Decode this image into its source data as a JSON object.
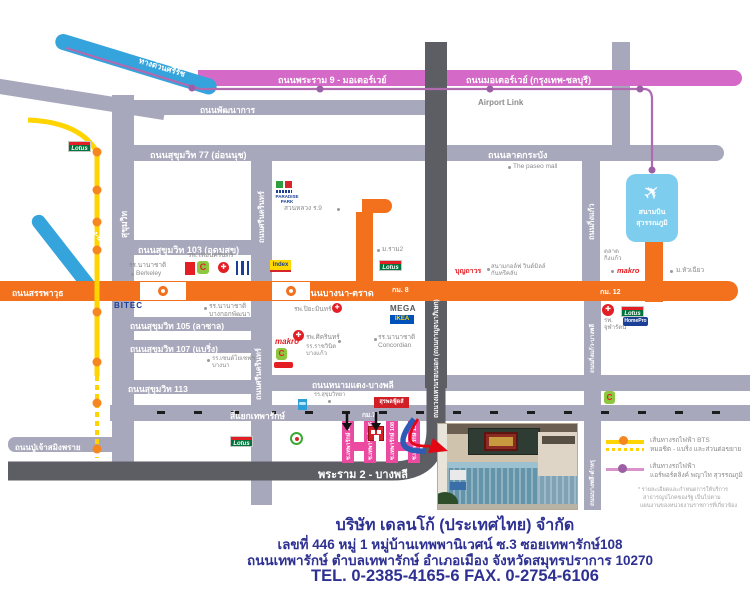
{
  "map": {
    "roads": {
      "expressway_srirat": "ทางด่วนศรีรัช",
      "rama9_motorway": "ถนนพระราม 9 - มอเตอร์เวย์",
      "motorway_bkk_chonburi": "ถนนมอเตอร์เวย์ (กรุงเทพ-ชลบุรี)",
      "airport_link": "Airport Link",
      "phetchaburi_tat_mai": "ถนนเพชรบุรีตัดใหม่",
      "phatthanakan": "ถนนพัฒนาการ",
      "sukhumvit77": "ถนนสุขุมวิท 77 (อ่อนนุช)",
      "lat_krabang": "ถนนลาดกระบัง",
      "sukhumvit": "สุขุมวิท",
      "sukhumvit103": "ถนนสุขุมวิท 103 (อุดมสุข)",
      "sukhumvit105": "ถนนสุขุมวิท 105 (ลาซาล)",
      "sukhumvit107": "ถนนสุขุมวิท 107 (แบริ่ง)",
      "sukhumvit113": "ถนนสุขุมวิท 113",
      "sanphawut": "ถนนสรรพาวุธ",
      "bangna_trat": "ถนนบางนา-ตราด",
      "km8": "กม. 8",
      "km12": "กม. 12",
      "km7": "กม.7",
      "srinagarindra": "ถนนศรีนครินทร์",
      "expressway_dindaeng_bangna": "ทางด่วน ดินแดง-บางนา",
      "outer_ring": "ถนนวงแหวนรอบนอก (ถนนกาญจนาภิเษก)",
      "king_kaeo": "ถนนกิ่งแก้ว",
      "king_kaeo_bangphli": "ถนนกิ่งแก้ว-บางพลี",
      "bangphli_tamru": "ถนนบางพลี-ตำหรุ",
      "namdaeng_bangphli": "ถนนหนามแดง-บางพลี",
      "thepharak_junction": "สี่แยกเทพารักษ์",
      "pujao_samingprai": "ถนนปู่เจ้าสมิงพราย",
      "rama2_bangphli": "พระราม 2 - บางพลี",
      "soi104": "ซ.เทพารักษ์ 104",
      "soi106": "ซ.เทพารักษ์ 106",
      "soi108": "ซ.เทพารักษ์ 108",
      "soi110": "ซ.เทพารักษ์ 110"
    },
    "landmarks": {
      "lotus": "Lotus",
      "bigc_letter": "C",
      "makro": "makro",
      "mega": "MEGA",
      "ikea": "IKEA",
      "index": "Index",
      "bitec": "BITEC",
      "homepro": "HomePro",
      "paradise_line1": "PARADISE",
      "paradise_line2": "PARK",
      "suan_luang": "สวนหลวง ร.9",
      "berkeley_line1": "รร.นานาชาติ",
      "berkeley_line2": "Berkeley",
      "thai_nakarin": "รพ.ไทยนครินทร์",
      "bangkok_patana_line1": "รร.นานาชาติ",
      "bangkok_patana_line2": "บางกอกพัฒนา",
      "piyamin": "รพ.ปิยะมินทร์",
      "sikarin": "รพ.ศิครินทร์",
      "ratwinit_line1": "รร.ราชวินิต",
      "ratwinit_line2": "บางแก้ว",
      "st_joseph_line1": "รร.เซนต์โยเซฟฯ",
      "st_joseph_line2": "บางนา",
      "concordian_line1": "รร.นานาชาติ",
      "concordian_line2": "Concordian",
      "ram2": "ม.ราม2",
      "boonthavorn": "บุญถาวร",
      "windmill_line1": "สนามกอล์ฟ วินด์มิลล์",
      "windmill_line2": "กันทรีคลับ",
      "talad_line1": "ตลาด",
      "talad_line2": "กิ่งแก้ว",
      "huachiew": "ม.หัวเฉียว",
      "chularat_line1": "รพ.",
      "chularat_line2": "จุฬารัตน์",
      "paseo": "The paseo mall",
      "airport_line1": "สนามบิน",
      "airport_line2": "สุวรรณภูมิ",
      "surapon": "สุรพลฟู้ดส์",
      "school_blue": "รร.สุขุมวิทยา"
    },
    "legend": {
      "bts_line1": "เส้นทางรถไฟฟ้า BTS",
      "bts_line2": "หมอชิต - แบริ่ง และส่วนต่อขยาย",
      "arl_line1": "เส้นทางรถไฟฟ้า",
      "arl_line2": "แอร์พอร์ตลิงค์ พญาไท สุวรรณภูมิ",
      "note1": "* รายละเอียดและกำหนดการให้บริการ",
      "note2": "สาธารณูปโภคของรัฐ เป็นไปตาม",
      "note3": "แผนงานของหน่วยงานราชการที่เกี่ยวข้อง"
    },
    "colors": {
      "road_gray": "#a8a8bc",
      "road_dark": "#5d5d64",
      "road_orange": "#f3701d",
      "motorway_pink": "#d569c8",
      "expressway_blue": "#35a4dc",
      "bts_yellow": "#ffd400",
      "bts_dot_orange": "#f6861f",
      "arl_purple": "#9c5fa5",
      "soi_pink": "#ec4aa0",
      "footer_navy": "#2e3192"
    }
  },
  "icons": {
    "plane": "✈",
    "cross": "✚"
  },
  "footer": {
    "company": "บริษัท เดลนโก้ (ประเทศไทย) จำกัด",
    "address1": "เลขที่ 446 หมู่ 1 หมู่บ้านเทพพานิเวศน์ ซ.3  ซอยเทพารักษ์108",
    "address2": "ถนนเทพารักษ์ ตำบลเทพารักษ์ อำเภอเมือง จังหวัดสมุทรปราการ 10270",
    "phone": "TEL. 0-2385-4165-6  FAX. 0-2754-6106"
  }
}
